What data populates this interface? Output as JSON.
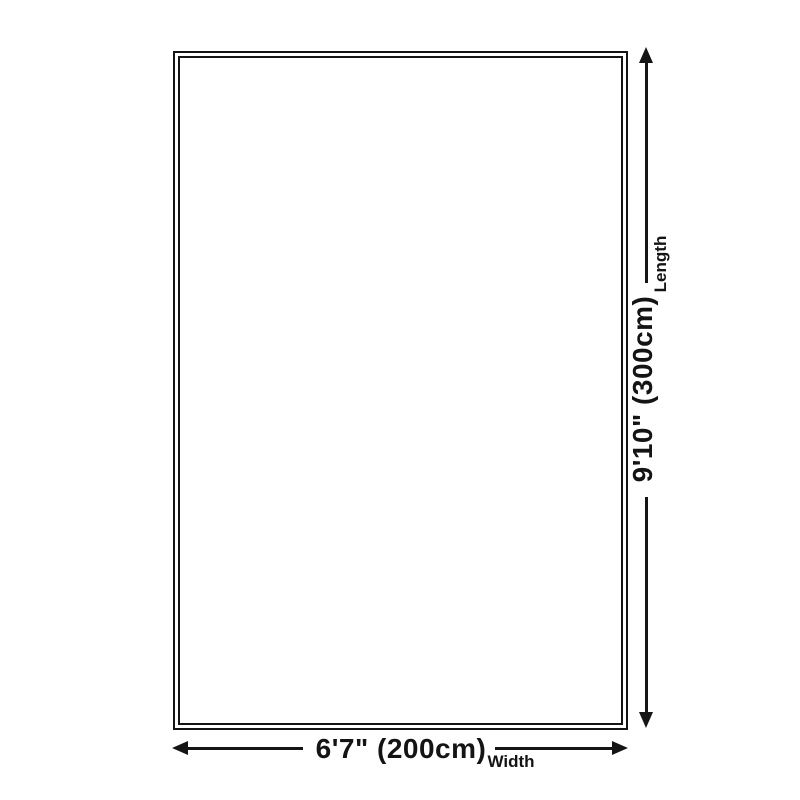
{
  "diagram": {
    "title": "rug-size-diagram",
    "length": {
      "value": "9'10\" (300cm)",
      "axis_label": "Length"
    },
    "width": {
      "value": "6'7\" (200cm)",
      "axis_label": "Width"
    }
  },
  "colors": {
    "background": "#ffffff",
    "line": "#151515",
    "text": "#141414"
  }
}
